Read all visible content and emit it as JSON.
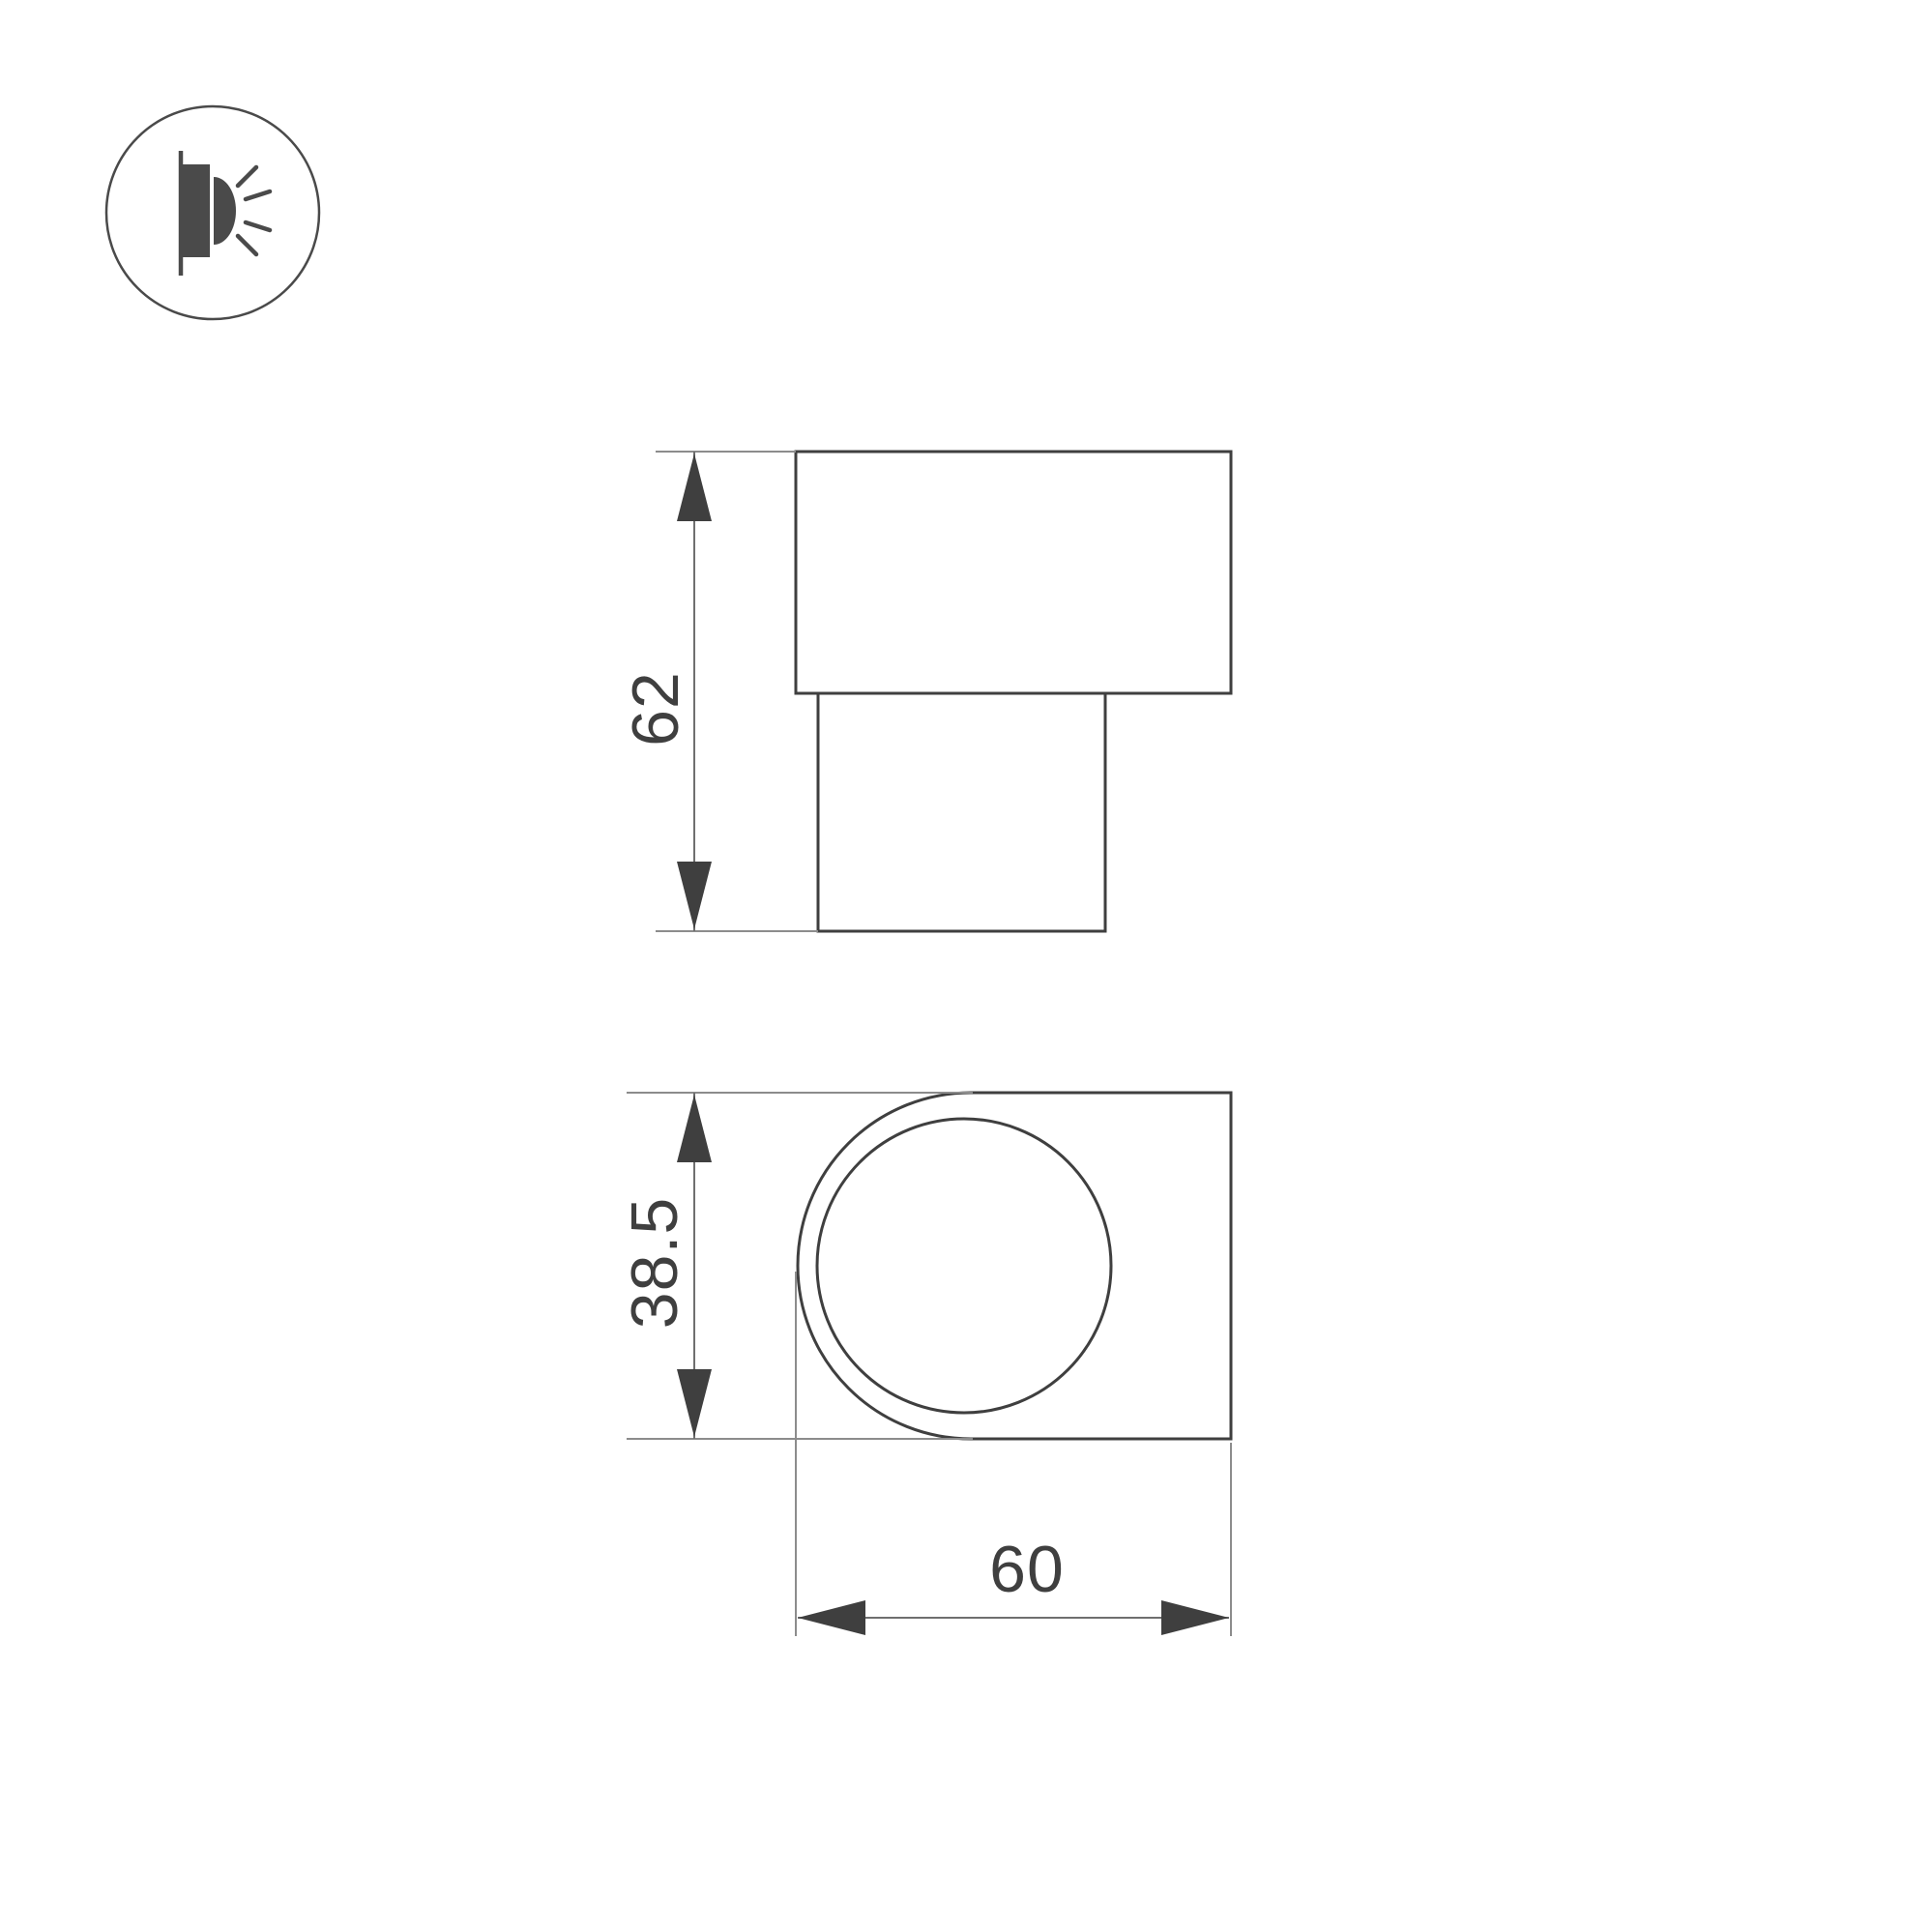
{
  "drawing": {
    "kind": "technical-dimension-drawing",
    "subject": "wall-mounted luminaire, two orthographic views"
  },
  "colors": {
    "background": "#ffffff",
    "object_line": "#3f3f3f",
    "dim_line": "#6f6f6f",
    "ext_line": "#8c8c8c",
    "text": "#3f3f3f",
    "icon_line": "#4a4a4a"
  },
  "icon": {
    "name": "wall-light-emitting-icon"
  },
  "views": {
    "side": {
      "name": "side-view",
      "height_label": "62"
    },
    "front": {
      "name": "front-view",
      "height_label": "38.5",
      "width_label": "60"
    }
  }
}
